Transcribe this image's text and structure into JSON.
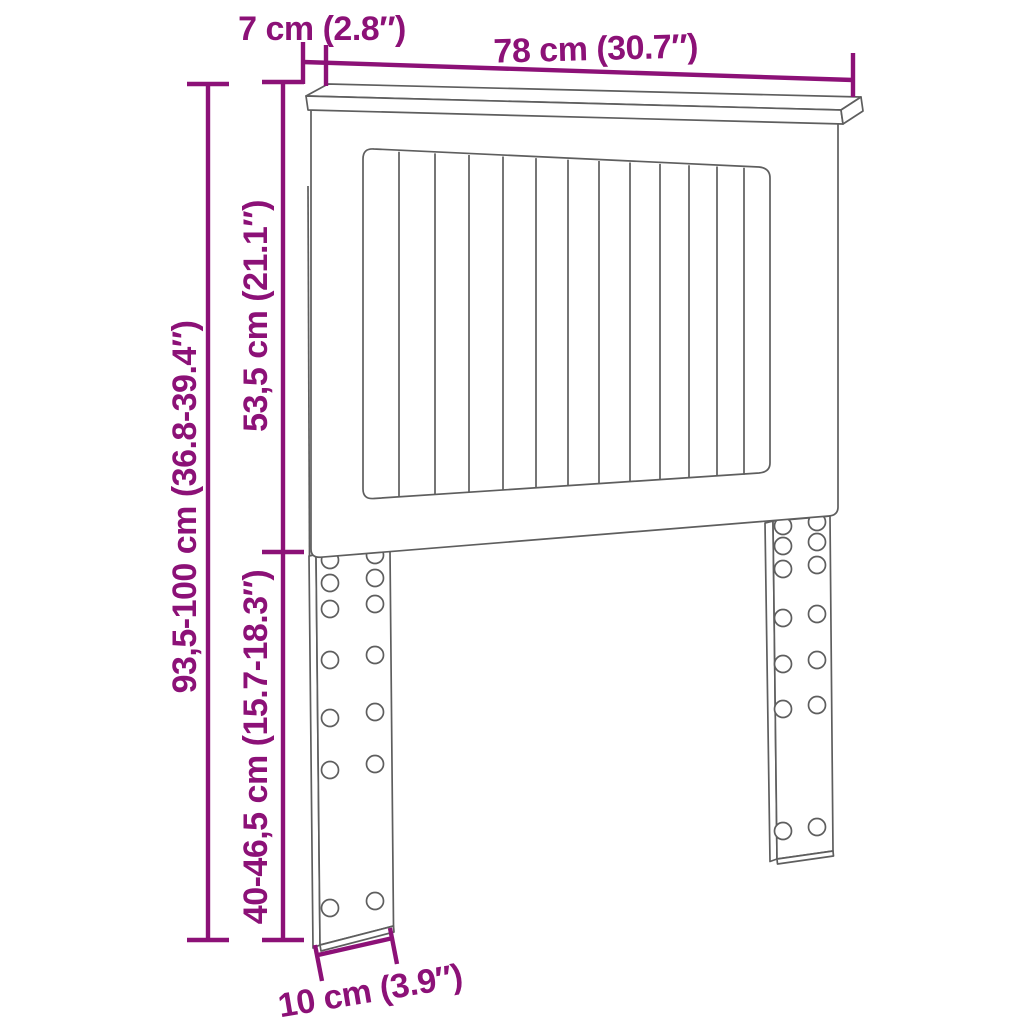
{
  "diagram": {
    "subject": "headboard-dimension-diagram",
    "accent_color": "#8C1177",
    "outline_color": "#5E5E5E",
    "background": "#FFFFFF",
    "labels": {
      "top_depth": "7 cm (2.8″)",
      "top_width": "78 cm (30.7″)",
      "upper_section_height": "53,5 cm (21.1″)",
      "total_height": "93,5-100 cm (36.8-39.4″)",
      "leg_section_height": "40-46,5 cm (15.7-18.3″)",
      "leg_width": "10 cm (3.9″)"
    }
  }
}
